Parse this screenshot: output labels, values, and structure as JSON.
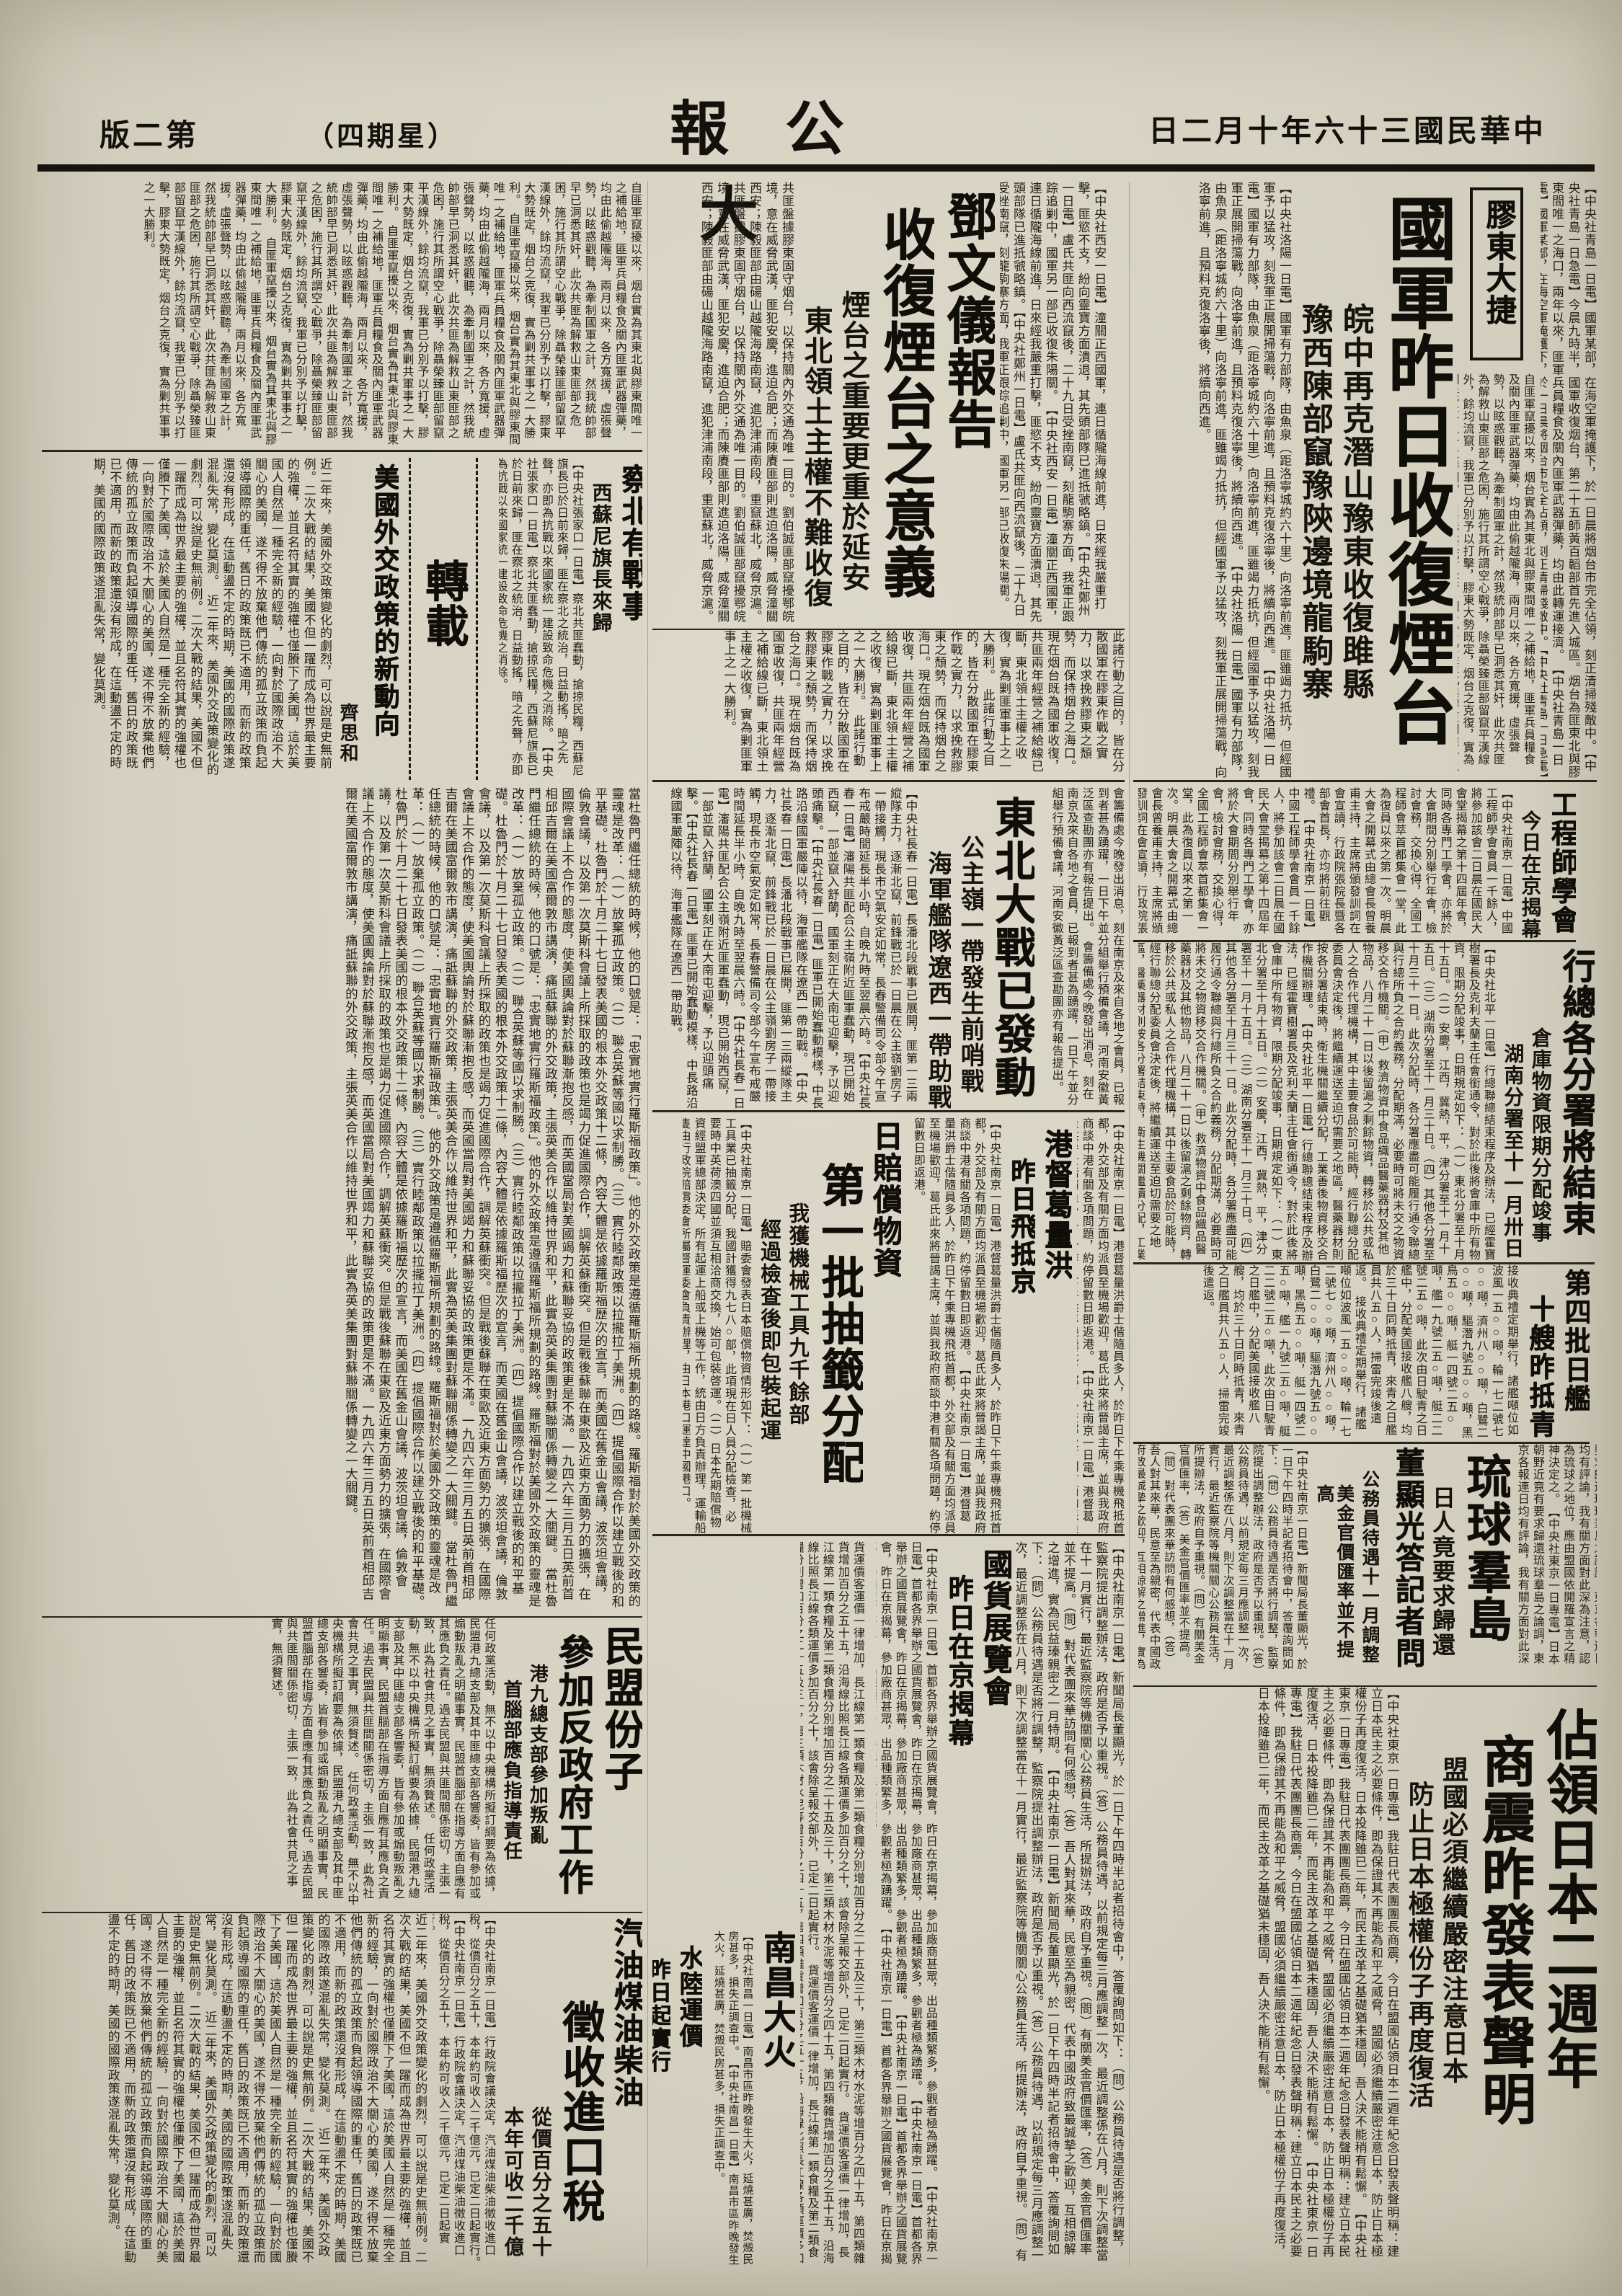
{
  "page": {
    "paper_color": "#d8d3c3",
    "ink_color": "#1c1913"
  },
  "header": {
    "date": "中華民國三十六年十月二日",
    "masthead": "大公報",
    "weekday": "（星期四）",
    "edition": "第二版"
  },
  "articles": {
    "lead": {
      "tag": "膠東大捷",
      "headline": "國軍昨日收復煙台",
      "sub1": "皖中再克潛山豫東收復雎縣",
      "sub2": "豫西陳部竄豫陝邊境龍駒寨",
      "body_right": "【中央社青島一日電】國軍某部，在海空軍掩護下，於一日晨將烟台市完全佔領，刻正清掃殘敵中。【中央社青島一日急電】今晨九時半，國軍收復烟台，第二十五師黃百韜部首先進入城區。烟台為匪東北與膠東間唯一之海口，兩年以來，匪軍兵員糧食及關內匪軍武器彈藥，均由此轉運接濟。",
      "body_left": "【中央社洛陽一日電】國軍有力部隊，由魚泉（距洛寧城約六十里）向洛寧前進，匪雖竭力抵抗，但經國軍予以猛攻，刻我軍正展開掃蕩戰，向洛寧前進，且預料克復洛寧後，將續向西進。",
      "body_wires2": "【中央社西安一日電】潼關正西國軍，連日循隴海線前進，日來經我嚴重打擊，匪慾不支，紛向靈寶方面潰退，其先頭部隊已進抵虢略鎮。【中央社鄭州一日電】盧氏共匪向西流竄後，二十九日受挫南竄，刻龍駒寨方面，我軍正跟踪追剿中，國軍另一部已收復朱陽關。"
    },
    "warnews": {
      "body": "自匪軍竄擾以來，烟台實為其東北與膠東間唯一之補給地，匪軍兵員糧食及關內匪軍武器彈藥，均由此偷越隴海，兩月以來，各方寬援，虛張聲勢，以眩惑觀聽，為牽制國軍之計，然我統帥部早已洞悉其奸，此次共匪為解救山東匪部之危困，施行其所謂空心戰爭，除聶榮臻匪部留竄平漢線外，餘均流竄，我軍已分別予以打擊，膠東大勢既定，烟台之克復，實為剿共軍事之一大勝利。"
    },
    "deng": {
      "kicker": "鄧文儀報告",
      "headline": "收復煙台之意義",
      "sub1": "煙台之重要更重於延安",
      "sub2": "東北領土主權不難收復",
      "body1": "共匪盤據膠東固守烟台，以保持關內外交通為唯一目的。劉伯誠匪部竄擾鄂皖境，意在威脅武漢，匪犯安慶，進迫合肥；而陳賡匪部則進迫洛陽，威脅潼關西安；陳毅匪部由碭山越隴海路南竄，進犯津浦南段，重竄蘇北，威脅京滬。",
      "body2": "此諸行動之目的，皆在分散國軍在膠東作戰之實力，以求挽救膠東之頹勢，而保持烟台之海口。現在烟台既為國軍收復，共匪兩年經營之補給線已斷，東北領土主權之收復，實為剿匪軍事上之一大勝利。"
    },
    "reprint": {
      "label": "轉載"
    },
    "chabei": {
      "headline": "察北有戰事",
      "sub": "西蘇尼旗長來歸",
      "body": "【中央社張家口一日電】察北共匪蠢動，搶掠民糧，西蘇尼旗長已於日前來歸，匪在察北之統治，日益動搖，暗之先聲，亦即為抗戰以來國家統一建設致命危機之消除。"
    },
    "usa": {
      "headline": "美國外交政策的新動向",
      "author": "齊思和",
      "body1": "近二年來，美國外交政策變化的劇烈，可以說是史無前例。二次大戰的結果，美國不但一躍而成為世界最主要的強權，並且名符其實的強權也僅賸下了美國，這於美國人自然是一種完全新的經驗，一向對於國際政治不大關心的美國，遂不得不放棄他們傳統的孤立政策而負起領導國際的重任，舊日的政策既已不適用，而新的政策還沒有形成，在這動盪不定的時期，美國的國際政策遂混亂失常，變化莫測。",
      "body2": "當杜魯門繼任總統的時候，他的口號是：「忠實地實行羅斯福政策」。他的外交政策是遵循羅斯福所規劃的路線。羅斯福對於美國外交政策的靈魂是改革：（一）放棄孤立政策。（二）聯合英蘇等國以求制勝。（三）實行睦鄰政策以拉攏拉丁美洲。（四）提倡國際合作以建立戰後的和平基礎。杜魯門於十月二十七日發表美國的根本外交政策十二條，內容大體是依據羅斯福歷次的宣言，而美國在舊金山會議，波茨坦會議，倫敦會議，以及第一次莫斯科會議上所採取的政策也是竭力促進國際合作，調解英蘇衝突。但是戰後蘇聯在東歐及近東方面勢力的擴張，在國際會議上不合作的態度，使美國輿論對於蘇聯漸抱反感，而英國當局對美國竭力和蘇聯妥協的政策更是不滿。一九四六年三月五日英前首相邱吉爾在美國富爾敦市講演，痛詆蘇聯的外交政策，主張英美合作以維持世界和平，此實為英美集團對蘇聯關係轉變之一大關鍵。"
    },
    "minmeng": {
      "head1": "民盟份子",
      "head2": "參加反政府工作",
      "sub1": "港九總支部參加叛亂",
      "sub2": "首腦部應負指導責任",
      "body": "任何政黨活動，無不以中央機構所擬訂綱要為依據，民盟港九總支部及其中匪總支部各響委，皆有參加或煽動叛亂之明顯事實，民盟首腦部在指導方面自應有其應負之責任。過去民盟與共匪間關係密切，主張一致，此為社會共見之事實，無須贅述。"
    },
    "qiyou": {
      "head1": "汽油煤油柴油",
      "head2": "徵收進口稅",
      "sub1": "從價百分之五十",
      "sub2": "本年可收二千億",
      "body": "【中央社南京一日電】行政院會議決定，汽油煤油柴油徵收進口稅，從價百分之五十，本年約可收入二千億元，已定二日起實行。"
    },
    "engineers": {
      "headline": "工程師學會",
      "sub": "今日在京揭幕",
      "body": "【中央社南京一日電】中國工程師學會會員一千餘人，將參加該會二日晨在國民大會堂揭幕之第十四屆年會，同時各專門工學會，亦將於大會期間分別舉行年會，檢討會務，交換心得，全國工程師會萃首都集會一堂，此為復員以來之第一次。明晨大會之開幕式由總會長曾養甫主持，主席將頒發訓詞在會宣讀，行政院張院長暨各部會首長，亦均將前往觀禮。"
    },
    "cnrra": {
      "headline": "行總各分署將結束",
      "sub1": "倉庫物資限期分配竣事",
      "sub2": "湖南分署至十一月卅日",
      "body": "【中央社北平一日電】行總聯總結束程序及辦法，已經霍寶樹署長及克利夫蘭主任會銜通令，對於此後將會庫中所有物資，限期分配竣事，日期規定如下：（一）東北分署至十月十五日。（二）安慶，江西，冀熱，平，津分署至十一月十五日。（三）湖南分署至十一月三十日。（四）其他各分署至十月三十一日。此次分配時，各分署應盡可能履行通令聯總與行總所負之合約義務，分配期滿，必要時可將未交之物資移交合作機關。（甲）救濟物資中食品織品醫藥器材及其他物品，八月二十一日以後留滬之剩餘物資，轉移於公共或私人之合作代理機構，其中主要食品於可能時，經行聯總分配委員會決定後，將繼續運送至迫切需要之地區，醫藥器材則按各分署結束時，衛生機關繼續分配，工業善後物資移交合作機關辦理。"
    },
    "ships": {
      "head1": "第四批日艦",
      "head2": "十艘昨抵青",
      "body": "接收典禮定期舉行，諸艦噸位如波風一五○○噸，輪一七二號七○○噸，濟州八○○噸，白鷺二○○噸，驅潛九號五○○噸，黑鳥五○○噸，艇一四號二五○噸，艦一九號二五○噸，艇二二號二五○噸，此次由日駛青之日艦中，分配美國接收艦八艘，均於三十日同時抵青，來青之日艦員共八五○人，掃雷完竣後遣返。"
    },
    "ryukyu": {
      "headline": "琉球羣島",
      "sub": "日人竟要求歸還",
      "body": "【中央社東京一日專電】日本朝野近竟有要求歸還琉球羣島之論調，東京各報連日均有評論，我有關方面對此深為注意，認為琉球之地位，應由盟國依開羅宣言之精神決定之。"
    },
    "dong": {
      "headline": "董顯光答記者問",
      "sub1": "公務員待遇十一月調整",
      "sub2": "美金官價匯率並不提高",
      "body": "【中央社南京一日電】新聞局長董顯光，於一日下午四時半記者招待會中，答覆詢問如下：（問）公務員待遇是否將行調整，監察院提出調整辦法，政府是否予以重視。（答）公務員待遇，以前規定每三月應調整一次，最近調整係在八月，則下次調整當在十一月實行，最近監察院等機關關心公務員生活，所提辦法，政府自予重視。（問）有關美金官價匯率，（答）美金官價匯率並不提高。（問）對代表團來華訪問有何感想，（答）吾人對其來華，民意至為親密，代表中國政府致最誠摯之歡迎，互相諒解之增進，實為民益瑧親密之一月特期。"
    },
    "hk": {
      "head1": "港督葛量洪",
      "head2": "昨日飛抵京",
      "body": "【中央社南京一日電】港督葛量洪爵士偕隨員多人，於昨日下午乘專機飛抵首都，外交部及有關方面均派員至機場歡迎，葛氏此來將晉謁主席，並與我政府商談中港有關各項問題，約停留數日即返港。"
    },
    "japan2": {
      "head1": "佔領日本二週年",
      "head2": "商震昨發表聲明",
      "sub1": "盟國必須繼續嚴密注意日本",
      "sub2": "防止日本極權份子再度復活",
      "body": "【中央社東京一日專電】我駐日代表團團長商震，今日在盟國佔領日本二週年紀念日發表聲明稱：建立日本民主之必要條件，即為保證其不再能為和平之威脅，盟國必須繼續嚴密注意日本，防止日本極權份子再度復活，日本投降雖已二年，而民主改革之基礎猶未穩固，吾人決不能稍有鬆懈。"
    },
    "guohuo": {
      "head1": "國貨展覽會",
      "head2": "昨日在京揭幕",
      "body": "【中央社南京一日電】首都各界舉辦之國貨展覽會，昨日在京揭幕，參加廠商甚眾，出品種類繁多，參觀者極為踴躍。"
    },
    "nanchang": {
      "headline": "南昌大火",
      "body": "【中央社南昌一日電】南昌市區昨晚發生大火，延燒甚廣，焚燬民房甚多，損失正調查中。"
    },
    "freight": {
      "head1": "水陸運價",
      "head2": "昨日起實行",
      "body": "貨運價客運價一律增加，長江線第一類食糧及第二類食糧分別增加百分之二十五及三十，第三類木材水泥等增百分之四十五，第四類雜貨增加百分之五十五，沿海線比照長江線各類運價多加百分之十，該會除呈報交部外，已定二日起實行。"
    },
    "dongbei": {
      "headline": "東北大戰已發動",
      "sub1": "公主嶺一帶發生前哨戰",
      "sub2": "海軍艦隊遼西一帶助戰",
      "body_right": "會籌備處今晚發出消息，刻在南京及來自各地之會員，已報到者甚為踴躍，一日下午並分組舉行預備會議，河南安徽黃泛區查勘團亦有報告提出。",
      "body": "【中央社長春一日電】長潘北段戰事已展開，匪第一三兩縱隊主力，逐漸北竄，前鋒戰已於一日晨在公主嶺劉房子一帶接觸，現長市空氣安定如常，長春警備司令部今午宣布戒嚴時間延長半小時，自晚九時至翌晨六時。【中央社長春一日電】瀋陽共匪配合公主嶺附近匪軍蠢動，現已開始西竄，一部並竄入舒蘭，國軍刻正在大南屯迎擊，予以迎頭痛擊。【中央社長春一日電】匪軍已開始蠢動模樣，中長路沿線國軍嚴陣以待，海軍艦隊在遼西一帶助戰。"
    },
    "peichang": {
      "kicker": "日賠償物資",
      "headline": "第一批抽籤分配",
      "sub1": "我獲機械工具九千餘部",
      "sub2": "經過檢查後即包裝起運",
      "body": "【中央社南京一日電】賠委會發表日本賠償物資情形如下：（一）第一批機械工具業已抽籤分配，我國計獲得九七八○部，此項現在日人員分配檢查，必要時中英荷澳四國並須互相洽商交換，始可包裝啓運。（二）日本先期賠償物資經盟軍總部決定，所有起運上船或上機等工作，統由日方負責辦理，運輸船隻由行政院賠償委會所屬督運委會負責辦理，由日本港口運達中國港口。"
    }
  }
}
